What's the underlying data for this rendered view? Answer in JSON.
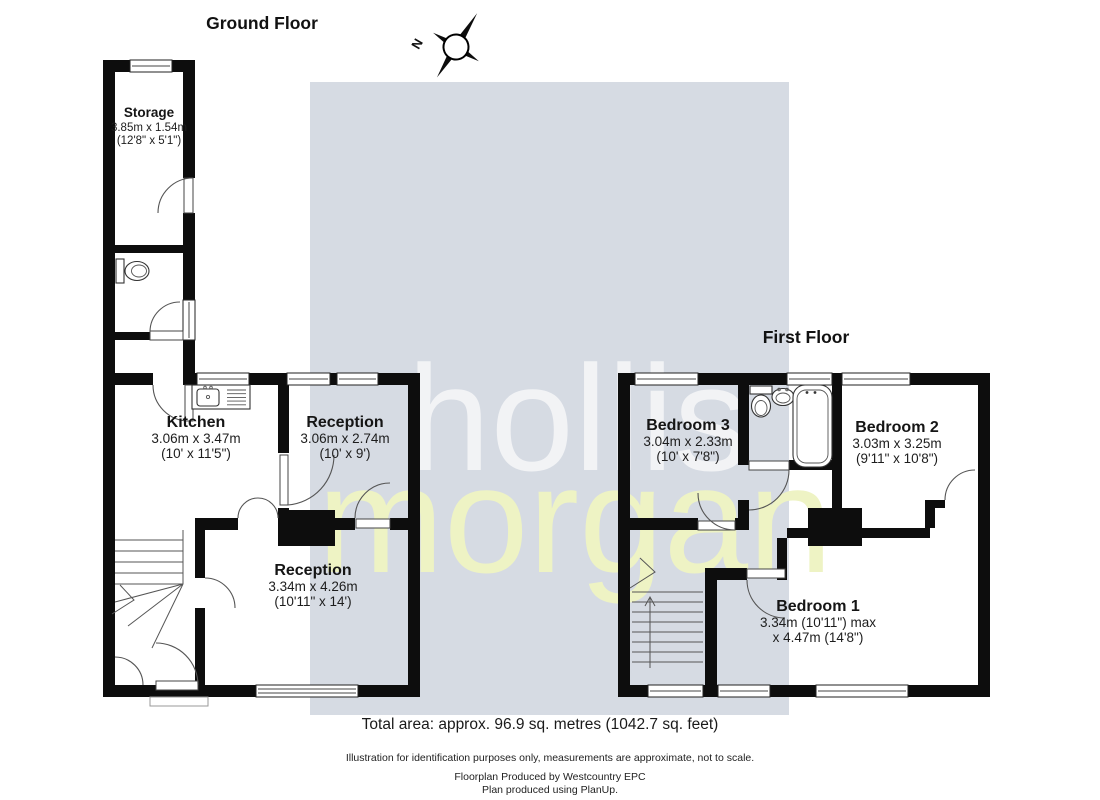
{
  "titles": {
    "ground": "Ground Floor",
    "first": "First Floor"
  },
  "compass": {
    "north_label": "N"
  },
  "watermark": {
    "line1": "hollis",
    "line2": "morgan",
    "bg_color": "#d6dbe3",
    "line1_color": "#f4f5f7",
    "line2_color": "#eef3c4"
  },
  "colors": {
    "wall": "#0d0d0d"
  },
  "rooms": {
    "storage": {
      "name": "Storage",
      "metric": "3.85m x 1.54m",
      "imperial": "(12'8\" x 5'1\")"
    },
    "kitchen": {
      "name": "Kitchen",
      "metric": "3.06m x 3.47m",
      "imperial": "(10' x 11'5\")"
    },
    "reception_front": {
      "name": "Reception",
      "metric": "3.06m x 2.74m",
      "imperial": "(10' x 9')"
    },
    "reception_rear": {
      "name": "Reception",
      "metric": "3.34m x 4.26m",
      "imperial": "(10'11\" x 14')"
    },
    "bedroom3": {
      "name": "Bedroom 3",
      "metric": "3.04m x 2.33m",
      "imperial": "(10' x 7'8\")"
    },
    "bedroom2": {
      "name": "Bedroom 2",
      "metric": "3.03m x 3.25m",
      "imperial": "(9'11\" x 10'8\")"
    },
    "bedroom1": {
      "name": "Bedroom 1",
      "metric": "3.34m (10'11\") max",
      "imperial": "x 4.47m (14'8\")"
    }
  },
  "footer": {
    "total_area": "Total area: approx. 96.9 sq. metres (1042.7 sq. feet)",
    "disclaimer": "Illustration for identification purposes only, measurements are approximate, not to scale.",
    "produced_by": "Floorplan Produced by Westcountry EPC",
    "produced_with": "Plan produced using PlanUp."
  }
}
